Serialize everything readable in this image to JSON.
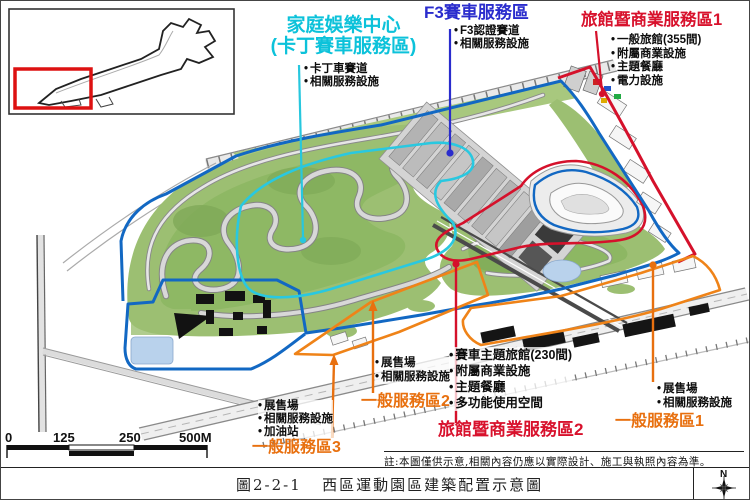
{
  "colors": {
    "label_cyan": "#0cc2da",
    "label_blue": "#2a2ccd",
    "label_red": "#d8112c",
    "label_orange": "#e8700f",
    "boundary_blue": "#1268c3",
    "boundary_cyan": "#29c8e0",
    "boundary_red": "#d5112b",
    "boundary_orange": "#ef8318",
    "terrain_green": "#9cbf72",
    "pond_blue": "#b9d2ec"
  },
  "zones": {
    "karting": {
      "title1": "家庭娛樂中心",
      "title2": "(卡丁賽車服務區)",
      "bullets": [
        "卡丁車賽道",
        "相關服務設施"
      ]
    },
    "f3": {
      "title": "F3賽車服務區",
      "bullets": [
        "F3認證賽道",
        "相關服務設施"
      ]
    },
    "hotel1": {
      "title": "旅館暨商業服務區1",
      "bullets": [
        "一般旅館(355間)",
        "附屬商業設施",
        "主題餐廳",
        "電力設施"
      ]
    },
    "hotel2": {
      "title": "旅館暨商業服務區2",
      "bullets": [
        "賽車主題旅館(230間)",
        "附屬商業設施",
        "主題餐廳",
        "多功能使用空間"
      ]
    },
    "general1": {
      "title": "一般服務區1",
      "bullets": [
        "展售場",
        "相關服務設施"
      ]
    },
    "general2": {
      "title": "一般服務區2",
      "bullets": [
        "展售場",
        "相關服務設施"
      ]
    },
    "general3": {
      "title": "一般服務區3",
      "bullets": [
        "展售場",
        "相關服務設施",
        "加油站"
      ]
    }
  },
  "scalebar": {
    "ticks": [
      "0",
      "125",
      "250",
      "500M"
    ]
  },
  "note": "註:本圖僅供示意,相關內容仍應以實際設計、施工與執照內容為準。",
  "caption": {
    "figure": "圖2-2-1",
    "title": "西區運動園區建築配置示意圖"
  },
  "compass": {
    "north": "N"
  }
}
